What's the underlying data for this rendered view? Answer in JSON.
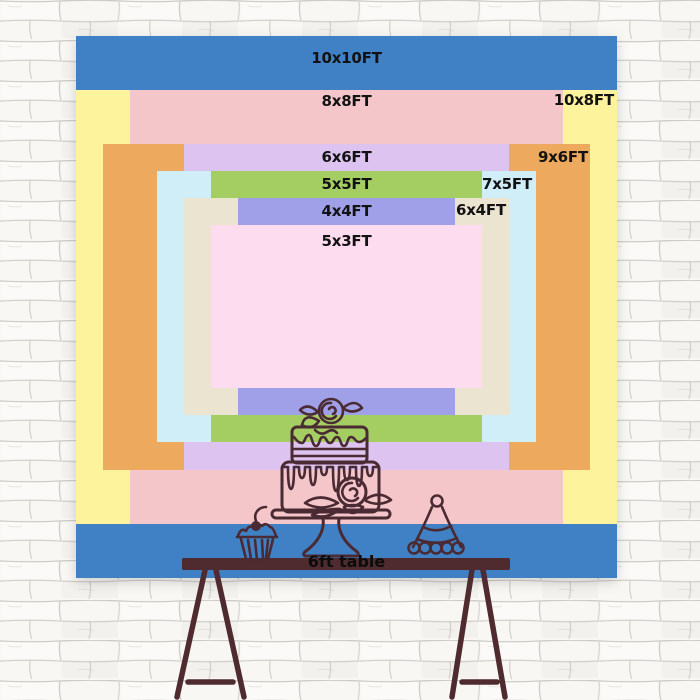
{
  "backdrop_chart": {
    "sizes": [
      {
        "id": "10x10",
        "label": "10x10FT",
        "width_ft": 10,
        "height_ft": 10,
        "color": "#4081c5",
        "label_placement": "top-center"
      },
      {
        "id": "10x8",
        "label": "10x8FT",
        "width_ft": 10,
        "height_ft": 8,
        "color": "#fdf39d",
        "label_placement": "top-right"
      },
      {
        "id": "8x8",
        "label": "8x8FT",
        "width_ft": 8,
        "height_ft": 8,
        "color": "#f4c6ca",
        "label_placement": "top-center"
      },
      {
        "id": "9x6",
        "label": "9x6FT",
        "width_ft": 9,
        "height_ft": 6,
        "color": "#edaa5f",
        "label_placement": "top-right"
      },
      {
        "id": "6x6",
        "label": "6x6FT",
        "width_ft": 6,
        "height_ft": 6,
        "color": "#ddc3ef",
        "label_placement": "top-center"
      },
      {
        "id": "7x5",
        "label": "7x5FT",
        "width_ft": 7,
        "height_ft": 5,
        "color": "#cfeef8",
        "label_placement": "top-right"
      },
      {
        "id": "5x5",
        "label": "5x5FT",
        "width_ft": 5,
        "height_ft": 5,
        "color": "#a5ce62",
        "label_placement": "top-center"
      },
      {
        "id": "6x4",
        "label": "6x4FT",
        "width_ft": 6,
        "height_ft": 4,
        "color": "#ebe4d1",
        "label_placement": "top-right"
      },
      {
        "id": "4x4",
        "label": "4x4FT",
        "width_ft": 4,
        "height_ft": 4,
        "color": "#9fa0e8",
        "label_placement": "top-center"
      },
      {
        "id": "5x3",
        "label": "5x3FT",
        "width_ft": 5,
        "height_ft": 3,
        "color": "#fcdcee",
        "label_placement": "top-center"
      }
    ]
  },
  "table": {
    "label": "6ft table",
    "length_ft": 6,
    "color": "#4f2b30"
  },
  "illustrations": {
    "line_color": "#4a2a33",
    "items": [
      "cake-icon",
      "cupcake-icon",
      "party-hat-icon"
    ]
  },
  "wall": {
    "brick_fill": "#f8f7f4",
    "mortar_line": "#c6c3bd"
  }
}
